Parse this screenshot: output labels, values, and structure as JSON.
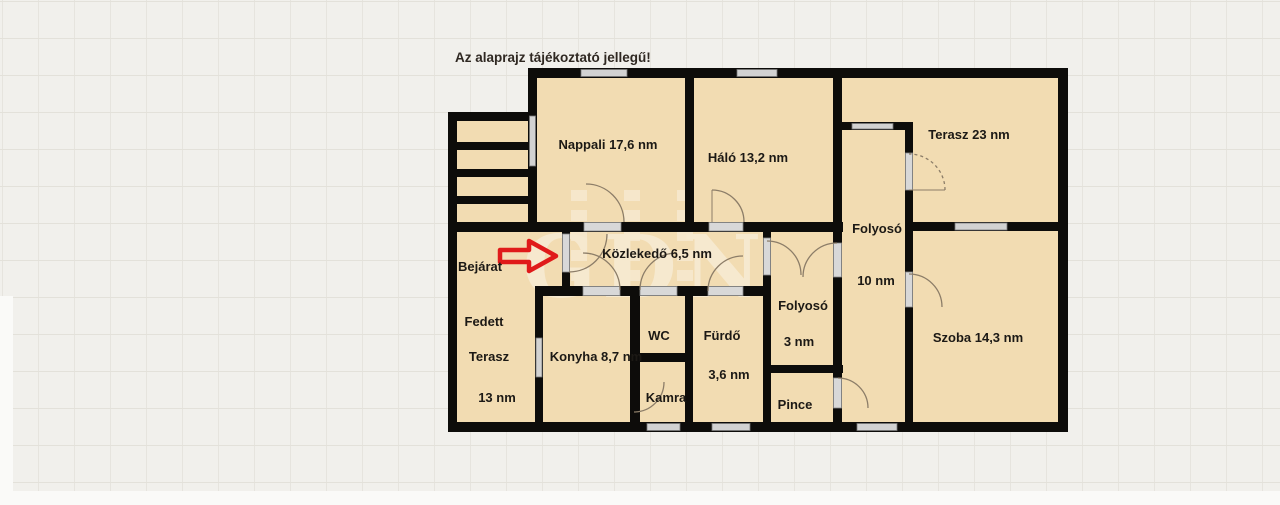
{
  "title": "Az alaprajz tájékoztató jellegű!",
  "watermark": "GDN",
  "colors": {
    "background": "#f1f0ec",
    "grid_line": "#e3e1da",
    "room_fill": "#f2dcb2",
    "wall": "#0d0c0a",
    "window_gray": "#d2d2d2",
    "door_arc": "#8c7d68",
    "arrow_red": "#e01a1a",
    "watermark_white": "#ffffff"
  },
  "rooms": {
    "nappali": "Nappali 17,6 nm",
    "halo": "Háló 13,2 nm",
    "terasz": "Terasz 23 nm",
    "folyoso10": {
      "name": "Folyosó",
      "area": "10 nm"
    },
    "kozlekedo": "Közlekedő 6,5 nm",
    "bejarat": "Bejárat",
    "fedett_terasz": {
      "line1": "Fedett",
      "line2": "Terasz",
      "line3": "13 nm"
    },
    "konyha": "Konyha 8,7 nm",
    "wc": "WC",
    "kamra": "Kamra",
    "furdo": {
      "name": "Fürdő",
      "area": "3,6 nm"
    },
    "folyoso3": {
      "name": "Folyosó",
      "area": "3 nm"
    },
    "pince": "Pince",
    "szoba": "Szoba 14,3 nm"
  }
}
